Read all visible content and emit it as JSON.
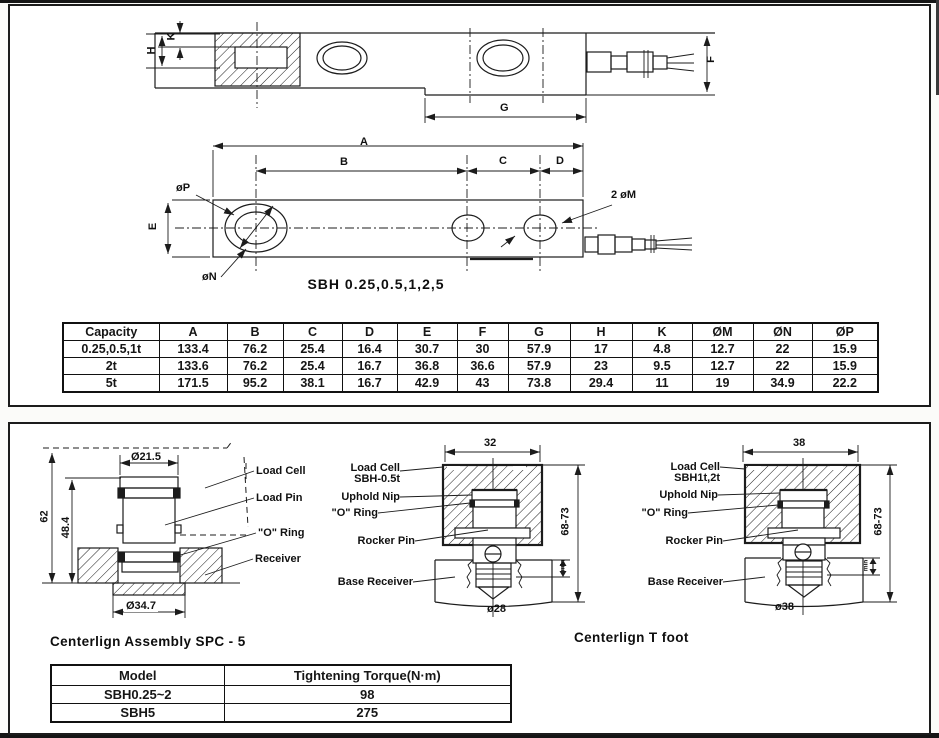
{
  "side_view": {
    "dim_h": "H",
    "dim_k": "K",
    "dim_g": "G",
    "dim_f": "F"
  },
  "top_view": {
    "dim_a": "A",
    "dim_b": "B",
    "dim_c": "C",
    "dim_d": "D",
    "dim_e": "E",
    "dim_p": "øP",
    "dim_n": "øN",
    "dim_m": "2 øM",
    "caption": "SBH 0.25,0.5,1,2,5"
  },
  "dim_table": {
    "headers": [
      "Capacity",
      "A",
      "B",
      "C",
      "D",
      "E",
      "F",
      "G",
      "H",
      "K",
      "ØM",
      "ØN",
      "ØP"
    ],
    "rows": [
      [
        "0.25,0.5,1t",
        "133.4",
        "76.2",
        "25.4",
        "16.4",
        "30.7",
        "30",
        "57.9",
        "17",
        "4.8",
        "12.7",
        "22",
        "15.9"
      ],
      [
        "2t",
        "133.6",
        "76.2",
        "25.4",
        "16.7",
        "36.8",
        "36.6",
        "57.9",
        "23",
        "9.5",
        "12.7",
        "22",
        "15.9"
      ],
      [
        "5t",
        "171.5",
        "95.2",
        "38.1",
        "16.7",
        "42.9",
        "43",
        "73.8",
        "29.4",
        "11",
        "19",
        "34.9",
        "22.2"
      ]
    ]
  },
  "assembly_left": {
    "dia_top": "Ø21.5",
    "dim_62": "62",
    "dim_484": "48.4",
    "dia_bottom": "Ø34.7",
    "load_cell": "Load Cell",
    "load_pin": "Load Pin",
    "o_ring": "\"O\" Ring",
    "receiver": "Receiver",
    "caption": "Centerlign Assembly SPC - 5"
  },
  "assembly_mid": {
    "dim_width": "32",
    "dim_height": "68-73",
    "dim_min": "min",
    "dia_bottom": "ø28",
    "load_cell": "Load Cell",
    "model": "SBH-0.5t",
    "uphold_nip": "Uphold Nip",
    "o_ring": "\"O\" Ring",
    "rocker_pin": "Rocker Pin",
    "base_receiver": "Base Receiver"
  },
  "assembly_right": {
    "dim_width": "38",
    "dim_height": "68-73",
    "dim_min": "min",
    "dia_bottom": "ø38",
    "load_cell": "Load Cell",
    "model": "SBH1t,2t",
    "uphold_nip": "Uphold Nip",
    "o_ring": "\"O\" Ring",
    "rocker_pin": "Rocker Pin",
    "base_receiver": "Base Receiver",
    "caption": "Centerlign T foot"
  },
  "torque_table": {
    "headers": [
      "Model",
      "Tightening Torque(N·m)"
    ],
    "rows": [
      [
        "SBH0.25~2",
        "98"
      ],
      [
        "SBH5",
        "275"
      ]
    ]
  }
}
